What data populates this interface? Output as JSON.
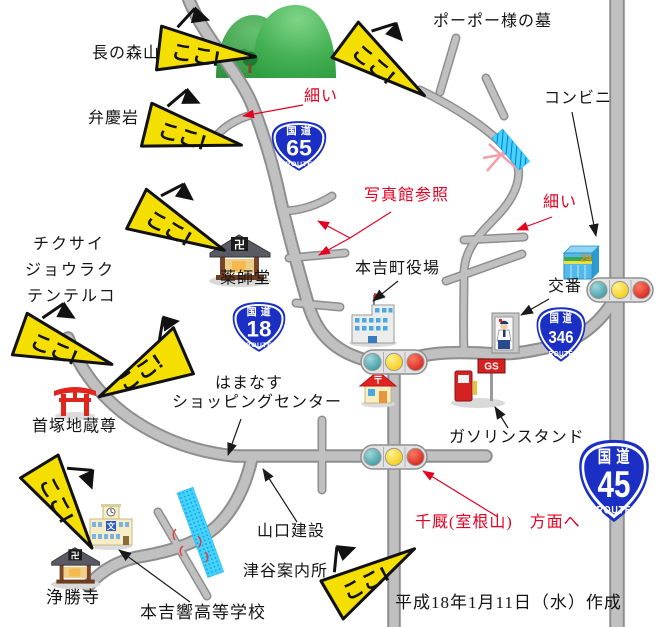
{
  "labels": {
    "naganomori": "長の森山",
    "benkei": "弁慶岩",
    "popo_grave": "ポーポー様の墓",
    "konbini": "コンビニ",
    "chikusai": "チクサイ",
    "jouraku": "ジョウラク",
    "tenteruko": "テンテルコ",
    "yakushido": "薬師堂",
    "town_hall": "本吉町役場",
    "kouban": "交番",
    "kubizuka": "首塚地蔵尊",
    "hamanasu_1": "はまなす",
    "hamanasu_2": "ショッピングセンター",
    "gas_stand": "ガソリンスタンド",
    "yamaguchi": "山口建設",
    "tsuya_annai": "津谷案内所",
    "joshoji": "浄勝寺",
    "high_school": "本吉響高等学校",
    "date_note": "平成18年1月11日（水）作成"
  },
  "red_notes": {
    "hosoi_1": "細い",
    "hosoi_2": "細い",
    "shashinkan": "写真館参照",
    "senmaya": "千厩(室根山)　方面へ"
  },
  "flags": {
    "label": "ここ!"
  },
  "routes": {
    "kokudo": "国道",
    "route_word": "ROUTE",
    "r65": "65",
    "r18": "18",
    "r346": "346",
    "r45": "45"
  },
  "glyphs": {
    "manji": "卍",
    "postal_mark": "〒",
    "school_mark": "文",
    "open24": "24",
    "gs": "GS"
  },
  "colors": {
    "road_fill": "#c0c0c0",
    "road_edge": "#8e8e8e",
    "flag_yellow": "#f4df00",
    "route_sign_blue": "#1b2fc4",
    "red_note": "#e60021",
    "river_cyan": "#44d2ff",
    "mountain_green": "#3fae4a"
  }
}
